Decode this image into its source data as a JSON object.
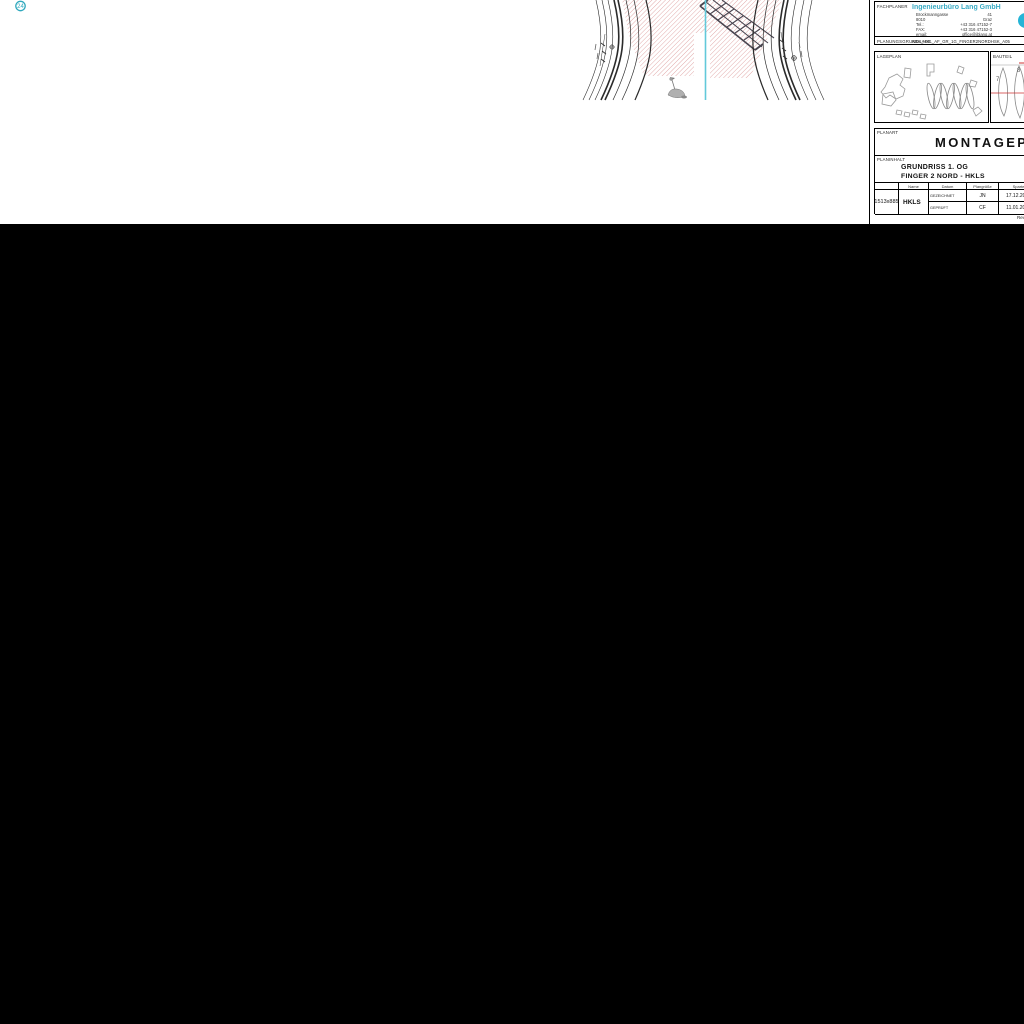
{
  "viewer": {
    "canvas_color": "#000000",
    "page_color": "#ffffff"
  },
  "annotation_marker": {
    "label": "24",
    "color": "#2fa8bd"
  },
  "drawing": {
    "hatch_color": "#dc9898",
    "centerline_color": "#62c9da",
    "structure_color": "#4a4550"
  },
  "title_block": {
    "fachplaner": {
      "label": "FACHPLANER",
      "company": "Ingenieurbüro Lang GmbH",
      "company_color": "#3aabc4",
      "address": [
        {
          "left": "Brockmanngasse",
          "right": "41"
        },
        {
          "left": "8010",
          "right": "Graz"
        },
        {
          "left": "Tel.:",
          "right": "+43 316 47152-7"
        },
        {
          "left": "FAX:",
          "right": "+43 316 47152-3"
        },
        {
          "left": "email:",
          "right": "office@iblang.at"
        }
      ]
    },
    "planungsgrundlage": {
      "label": "PLANUNGSGRUNDLAGE",
      "value": "KBH_HKL_AF_GR_1G_FINGER2NORDHSK_A05"
    },
    "lageplan": {
      "label": "LAGEPLAN"
    },
    "bauteil": {
      "label": "BAUTEIL",
      "finger_numbers": [
        "7",
        "8"
      ],
      "marker_color": "#cc3333"
    },
    "planart": {
      "label": "PLANART",
      "value": "MONTAGEPLAN"
    },
    "planinhalt": {
      "label": "PLANINHALT",
      "line1": "GRUNDRISS 1. OG",
      "line2": "FINGER 2 NORD - HKLS"
    },
    "approval_table": {
      "headers": {
        "name": "Name",
        "date": "Datum",
        "size": "Plangröße",
        "trade": "Sparte"
      },
      "rows": [
        {
          "label": "GEZEICHNET",
          "name": "JN",
          "date": "17.12.2020"
        },
        {
          "label": "GEPRÜFT",
          "name": "CF",
          "date": "11.01.2021"
        }
      ],
      "plan_size": "1513x885",
      "trade": "HKLS"
    },
    "revision_note": "Rev."
  }
}
